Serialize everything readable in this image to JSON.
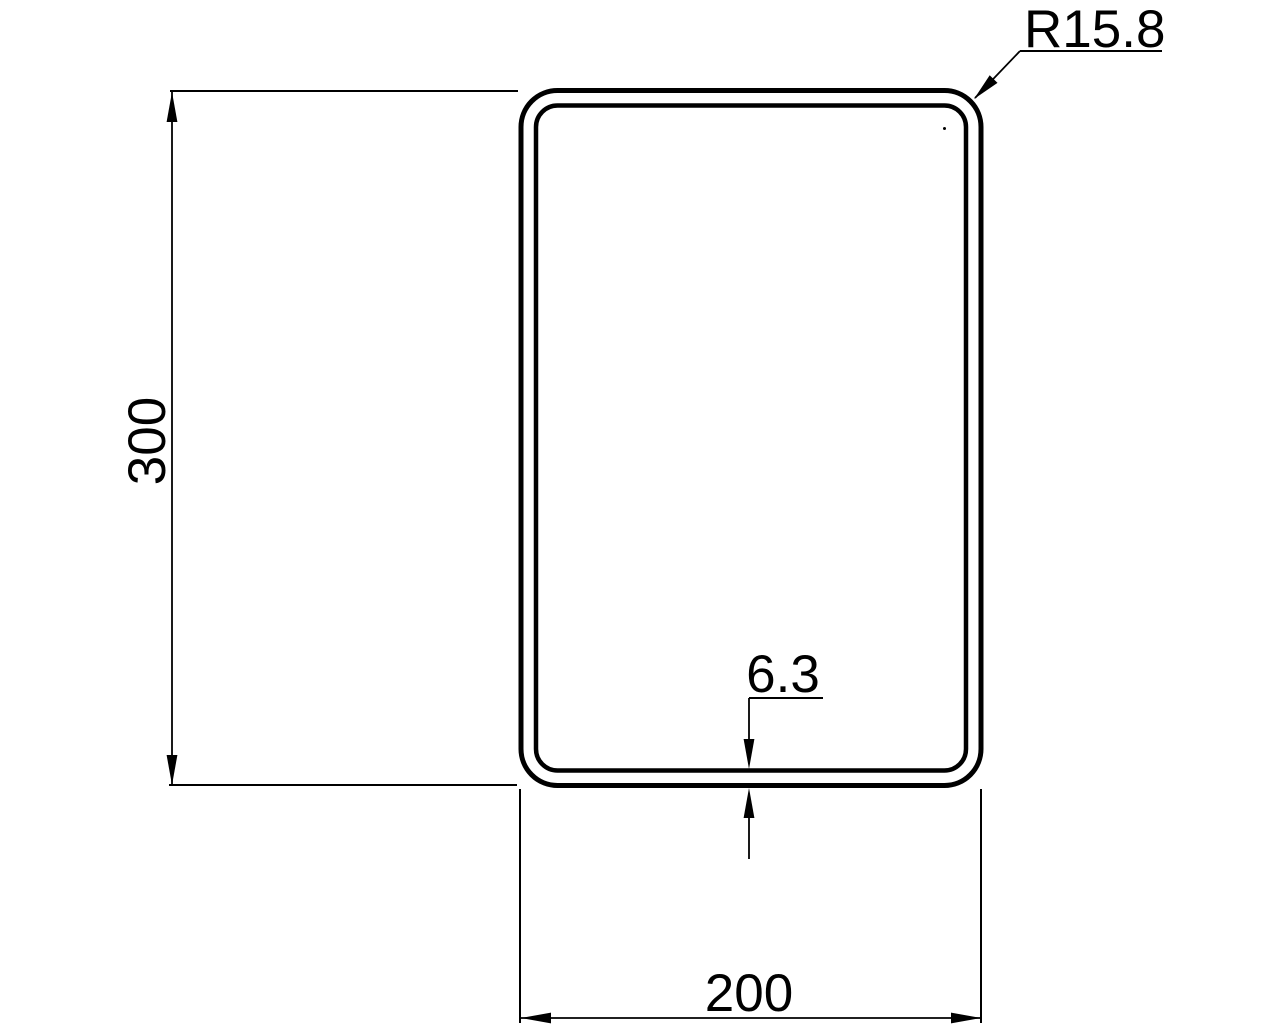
{
  "page": {
    "background_color": "#ffffff",
    "line_color": "#000000"
  },
  "drawing": {
    "kind": "tube-cross-section-engineering-drawing",
    "shape": "rounded-rectangle hollow profile (double outline)",
    "dimensions": {
      "height_label": "300",
      "width_label": "200",
      "wall_thickness_label": "6.3",
      "corner_radius_label": "R15.8"
    }
  }
}
